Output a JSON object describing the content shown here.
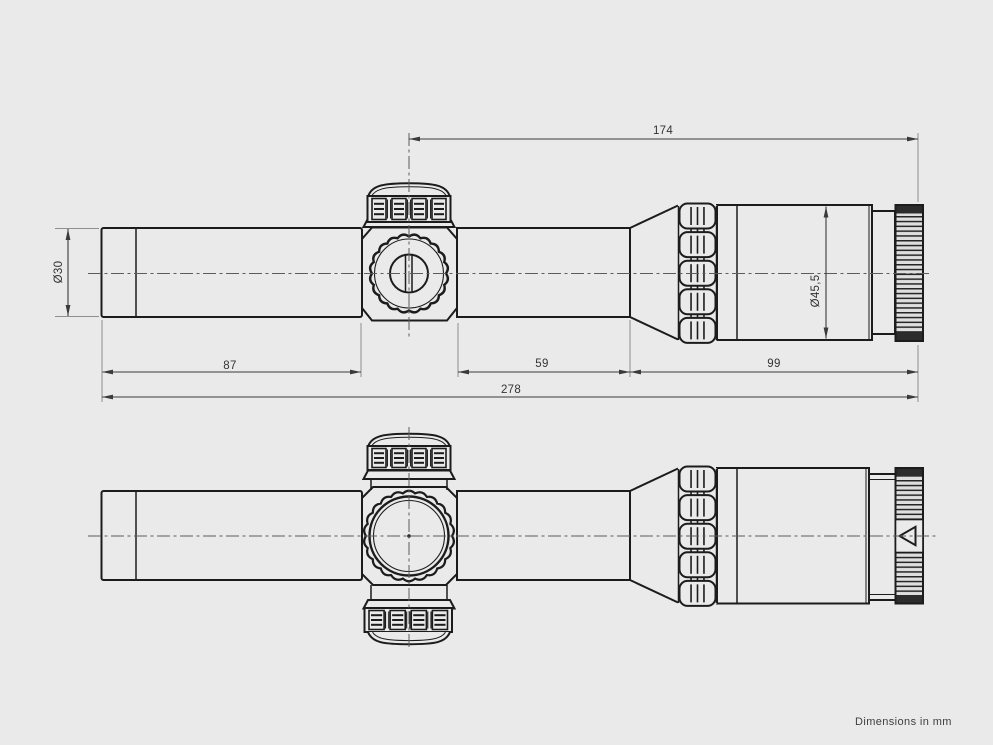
{
  "drawing": {
    "type": "technical-drawing",
    "subject": "riflescope two-view dimensional drawing",
    "units": "mm",
    "dimensions": {
      "turret_to_rear": "174",
      "tube_diameter": "Ø30",
      "front_tube_length": "87",
      "rear_tube_length": "59",
      "eyepiece_length": "99",
      "overall_length": "278",
      "eyepiece_diameter": "Ø45,5"
    },
    "footer_note": "Dimensions in mm"
  }
}
